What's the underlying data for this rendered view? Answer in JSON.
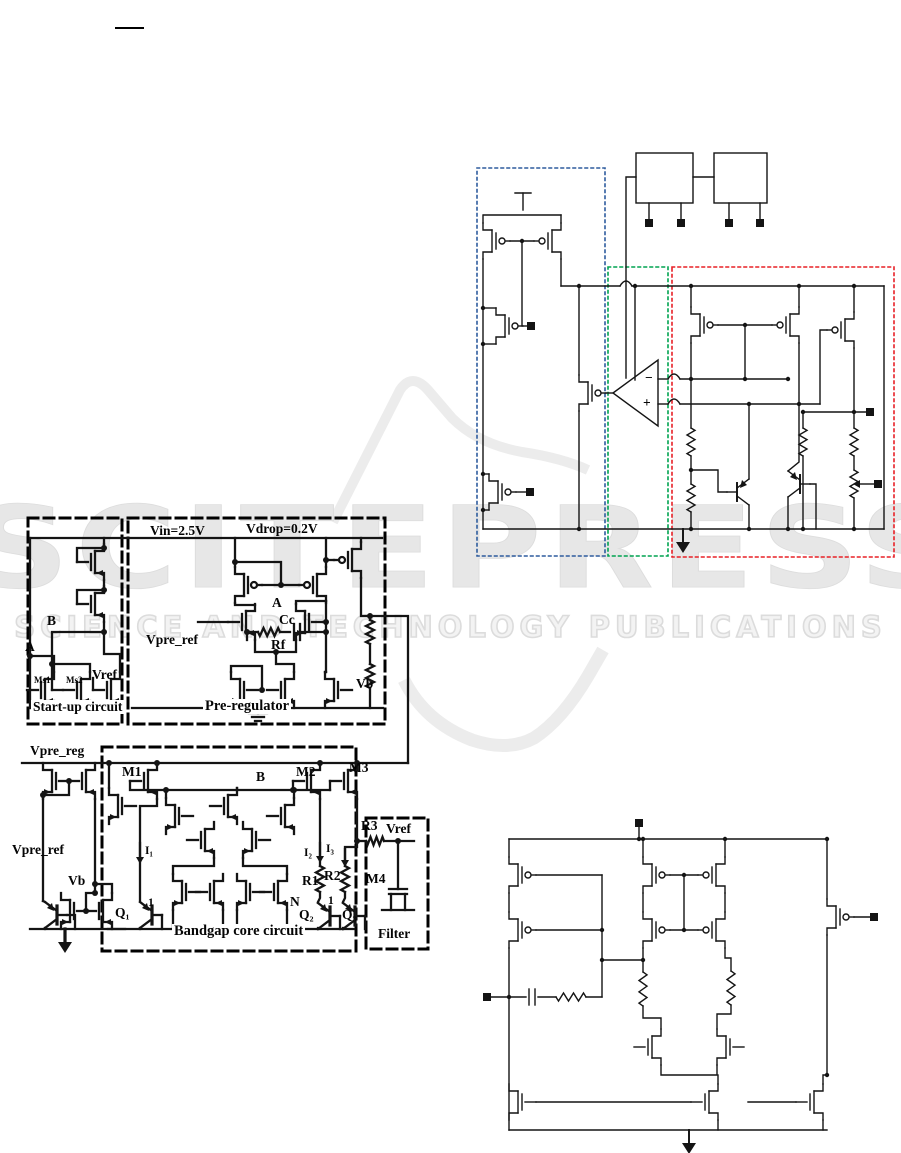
{
  "page": {
    "width": 901,
    "height": 1153,
    "background": "#ffffff"
  },
  "watermark": {
    "wordmark": "SCITEPRESS",
    "tagline": "SCIENCE AND TECHNOLOGY PUBLICATIONS",
    "color": "#e7e7e7"
  },
  "figure_regulator": {
    "labels": {
      "vin": "Vin=2.5V",
      "vdrop": "Vdrop=0.2V",
      "node_b": "B",
      "node_a": "A",
      "ms1": "Ms1",
      "ms2": "Ms2",
      "vref": "Vref",
      "startup_title": "Start-up circuit",
      "vpre_ref": "Vpre_ref",
      "node_a2": "A",
      "cc": "Cc",
      "rf": "Rf",
      "vb": "Vb",
      "title": "Pre-regulator"
    }
  },
  "figure_bandgap": {
    "labels": {
      "vpre_reg": "Vpre_reg",
      "vpre_ref": "Vpre_ref",
      "vb": "Vb",
      "m1": "M1",
      "node_b": "B",
      "m2": "M2",
      "m3": "M3",
      "i1": "I₁",
      "i2": "I₂",
      "i3": "I₃",
      "r1": "R1",
      "r2": "R2",
      "r3": "R3",
      "node_n": "N",
      "node_1a": "1",
      "node_1b": "1",
      "q1": "Q₁",
      "q2": "Q₂",
      "q3": "Q₃",
      "vref": "Vref",
      "m4": "M4",
      "core_title": "Bandgap core circuit",
      "filter_title": "Filter"
    }
  },
  "figure_transistor_level": {
    "opamp_minus": "−",
    "opamp_plus": "+",
    "region_colors": {
      "blue": "#2e5c9e",
      "green": "#00a350",
      "red": "#e82127"
    }
  },
  "figure_error_amplifier": {
    "labels": {}
  }
}
